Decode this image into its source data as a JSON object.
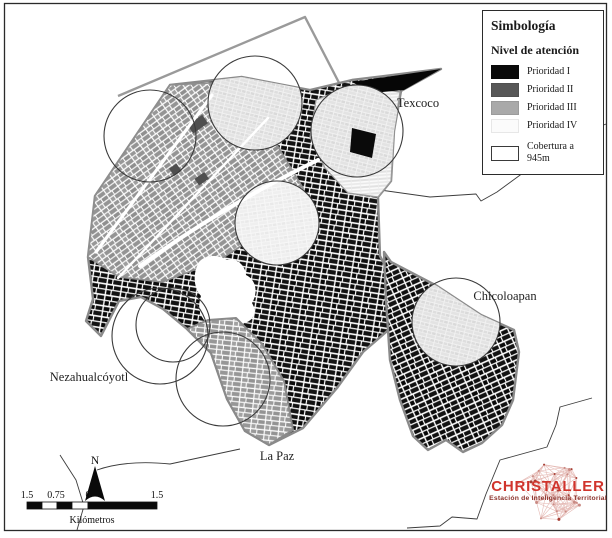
{
  "map": {
    "labels": {
      "texcoco": "Texcoco",
      "chicoloapan": "Chicoloapan",
      "nezahualcoyotl": "Nezahualcóyotl",
      "la_paz": "La Paz"
    }
  },
  "legend": {
    "title": "Simbología",
    "section_title": "Nivel de atención",
    "items": [
      {
        "label": "Prioridad I",
        "color": "#0a0a0a"
      },
      {
        "label": "Prioridad II",
        "color": "#575757"
      },
      {
        "label": "Prioridad III",
        "color": "#a9a9a9"
      },
      {
        "label": "Prioridad IV",
        "color": "#fbfbfb"
      }
    ],
    "coverage": {
      "label": "Cobertura a 945m",
      "color": "#ffffff"
    }
  },
  "scale_bar": {
    "ticks": [
      "1.5",
      "0.75",
      "0",
      "1.5"
    ],
    "unit": "Kilómetros",
    "north_label": "N"
  },
  "logo": {
    "name": "CHRISTALLER",
    "tagline": "Estación de Inteligencia Territorial",
    "accent_color": "#d0342c"
  }
}
